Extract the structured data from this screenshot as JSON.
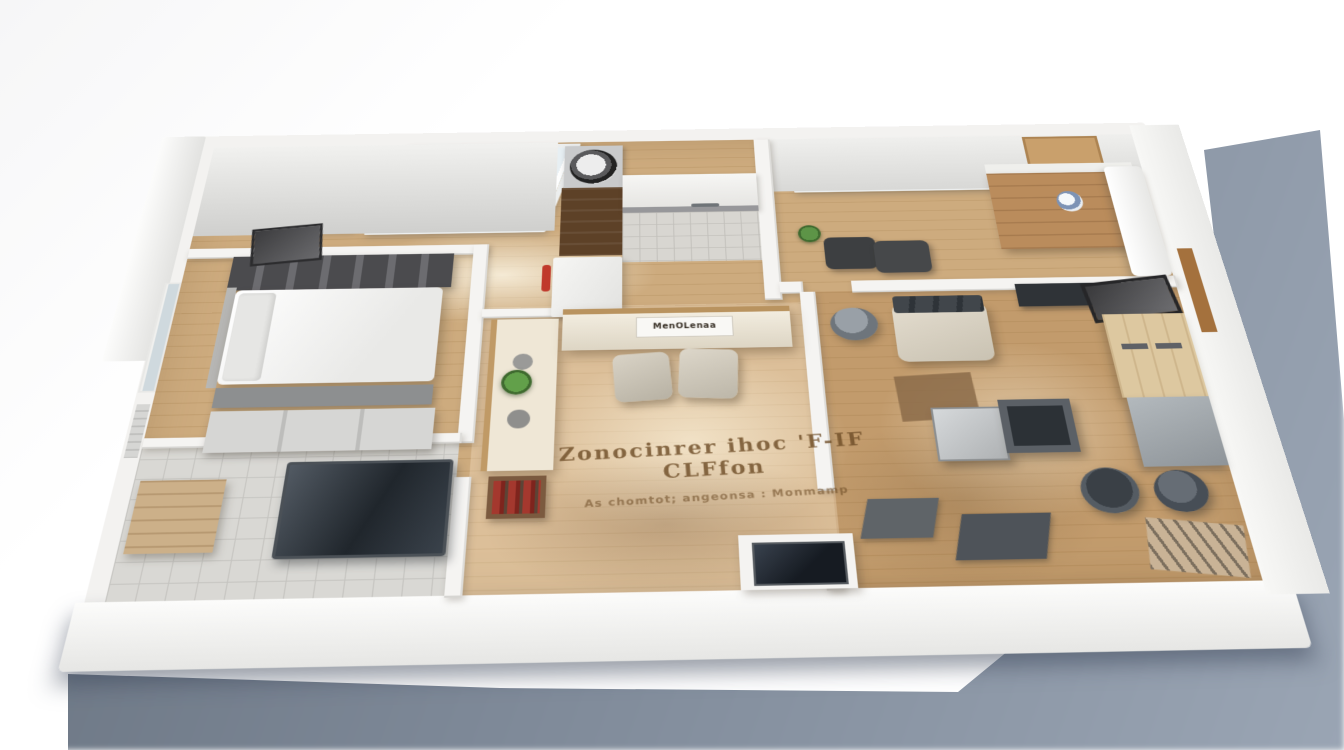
{
  "scene": {
    "floor_text": {
      "line1": "Zonocinrer ihoc 'F-IF CLFfon",
      "line2": "As chomtot; angeonsa : Monmamp"
    },
    "sideboard_label": "MenOLenaa",
    "colors": {
      "background": "#ffffff",
      "ground_shadow_dark": "#66707d",
      "ground_shadow_light": "#9aa5b4",
      "wood_floor_light": "#cdab7e",
      "wood_floor_dark": "#c09d6e",
      "wall_white": "#f3f2f0",
      "bath_tile": "#d9d8d4",
      "skylight_glass": "#e7eff3",
      "kitchen_cabinet_wood": "#5d4127",
      "desk_wood": "#ba8c5c",
      "wardrobe_wood": "#ddc8a0",
      "accent_red": "#c0392b",
      "plant_green": "#5d9447",
      "floor_text_brown": "#6f4e28"
    }
  }
}
